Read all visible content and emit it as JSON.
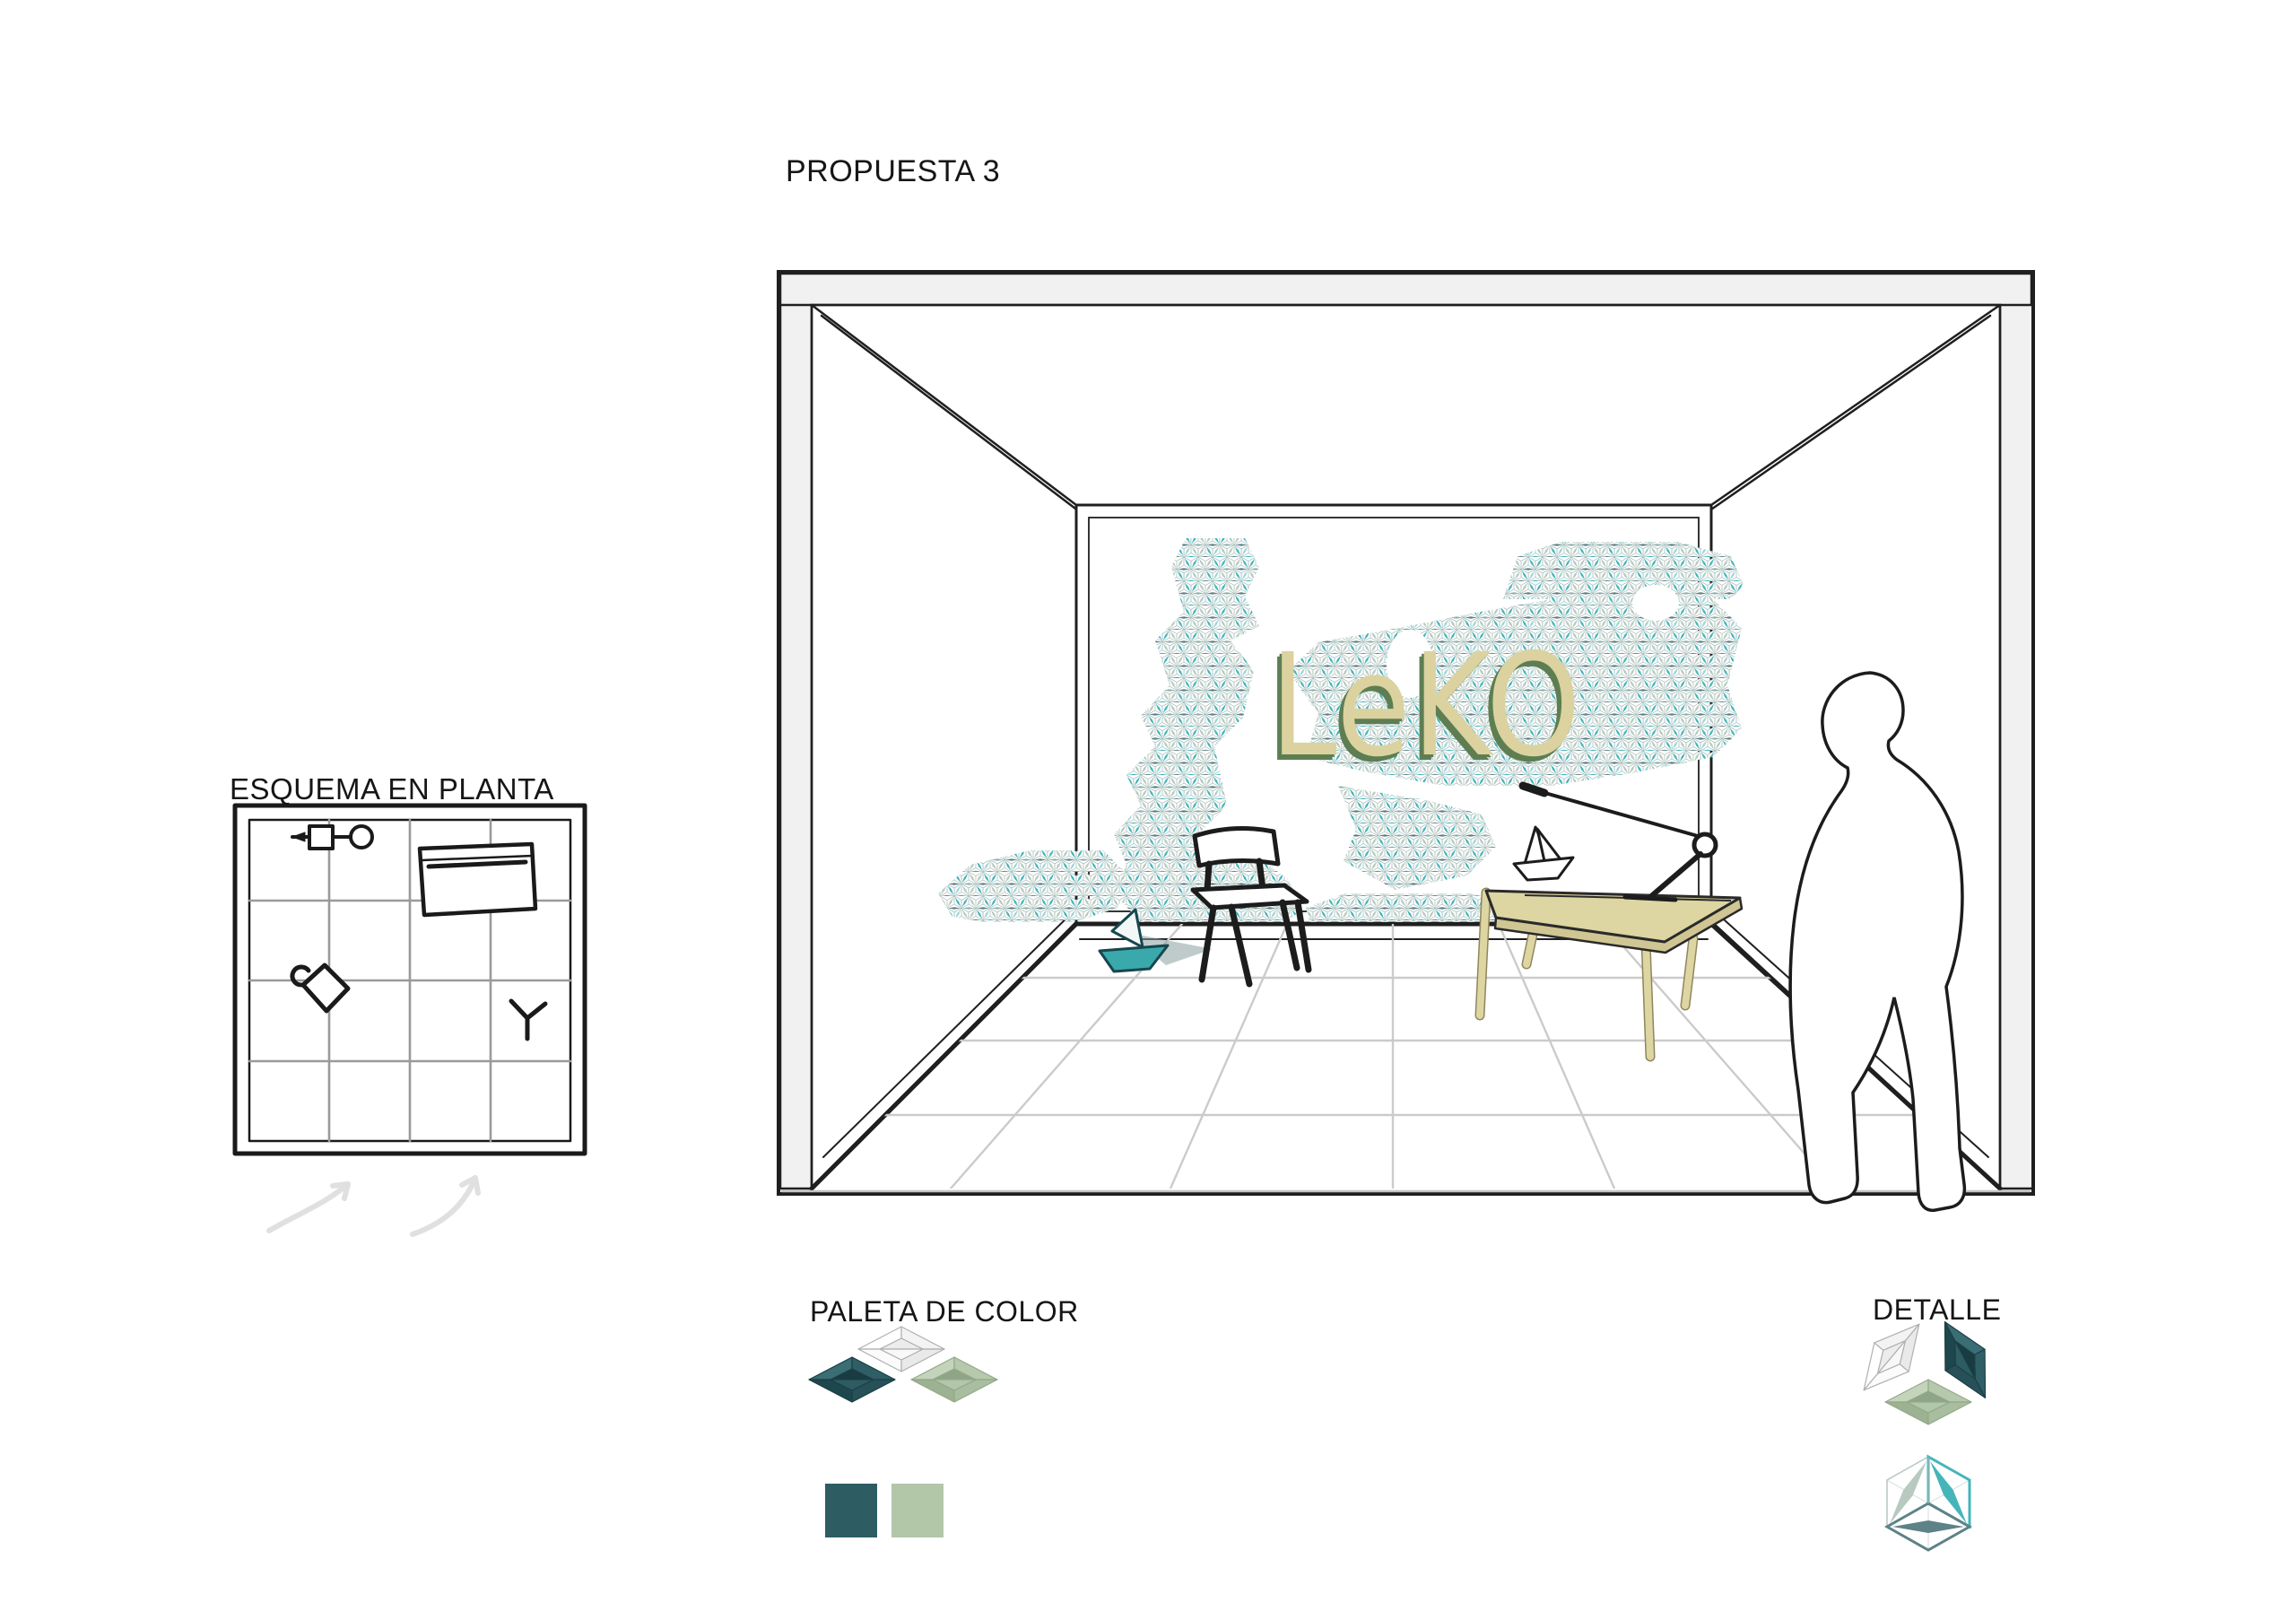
{
  "title": "PROPUESTA 3",
  "plan": {
    "label": "ESQUEMA EN PLANTA"
  },
  "mural": {
    "logo_text": "LeKO",
    "logo_color": "#dbd2a0",
    "logo_shadow_color": "#5e7e52",
    "tile_colors": {
      "teal": "#45b5ba",
      "sage": "#b7c9c0",
      "slate": "#5d8287"
    }
  },
  "palette": {
    "label": "PALETA DE COLOR",
    "tiles": [
      "white",
      "dark-teal",
      "sage-green"
    ],
    "swatches": [
      {
        "name": "dark-teal",
        "hex": "#2d5c63"
      },
      {
        "name": "sage-green",
        "hex": "#b2c6a8"
      }
    ]
  },
  "detail": {
    "label": "DETALLE",
    "tiles": [
      "white",
      "dark-teal",
      "sage-green"
    ],
    "cube_leaf_colors": {
      "left": "#b7c9c0",
      "right": "#45b5ba",
      "bottom": "#5d8287"
    }
  }
}
